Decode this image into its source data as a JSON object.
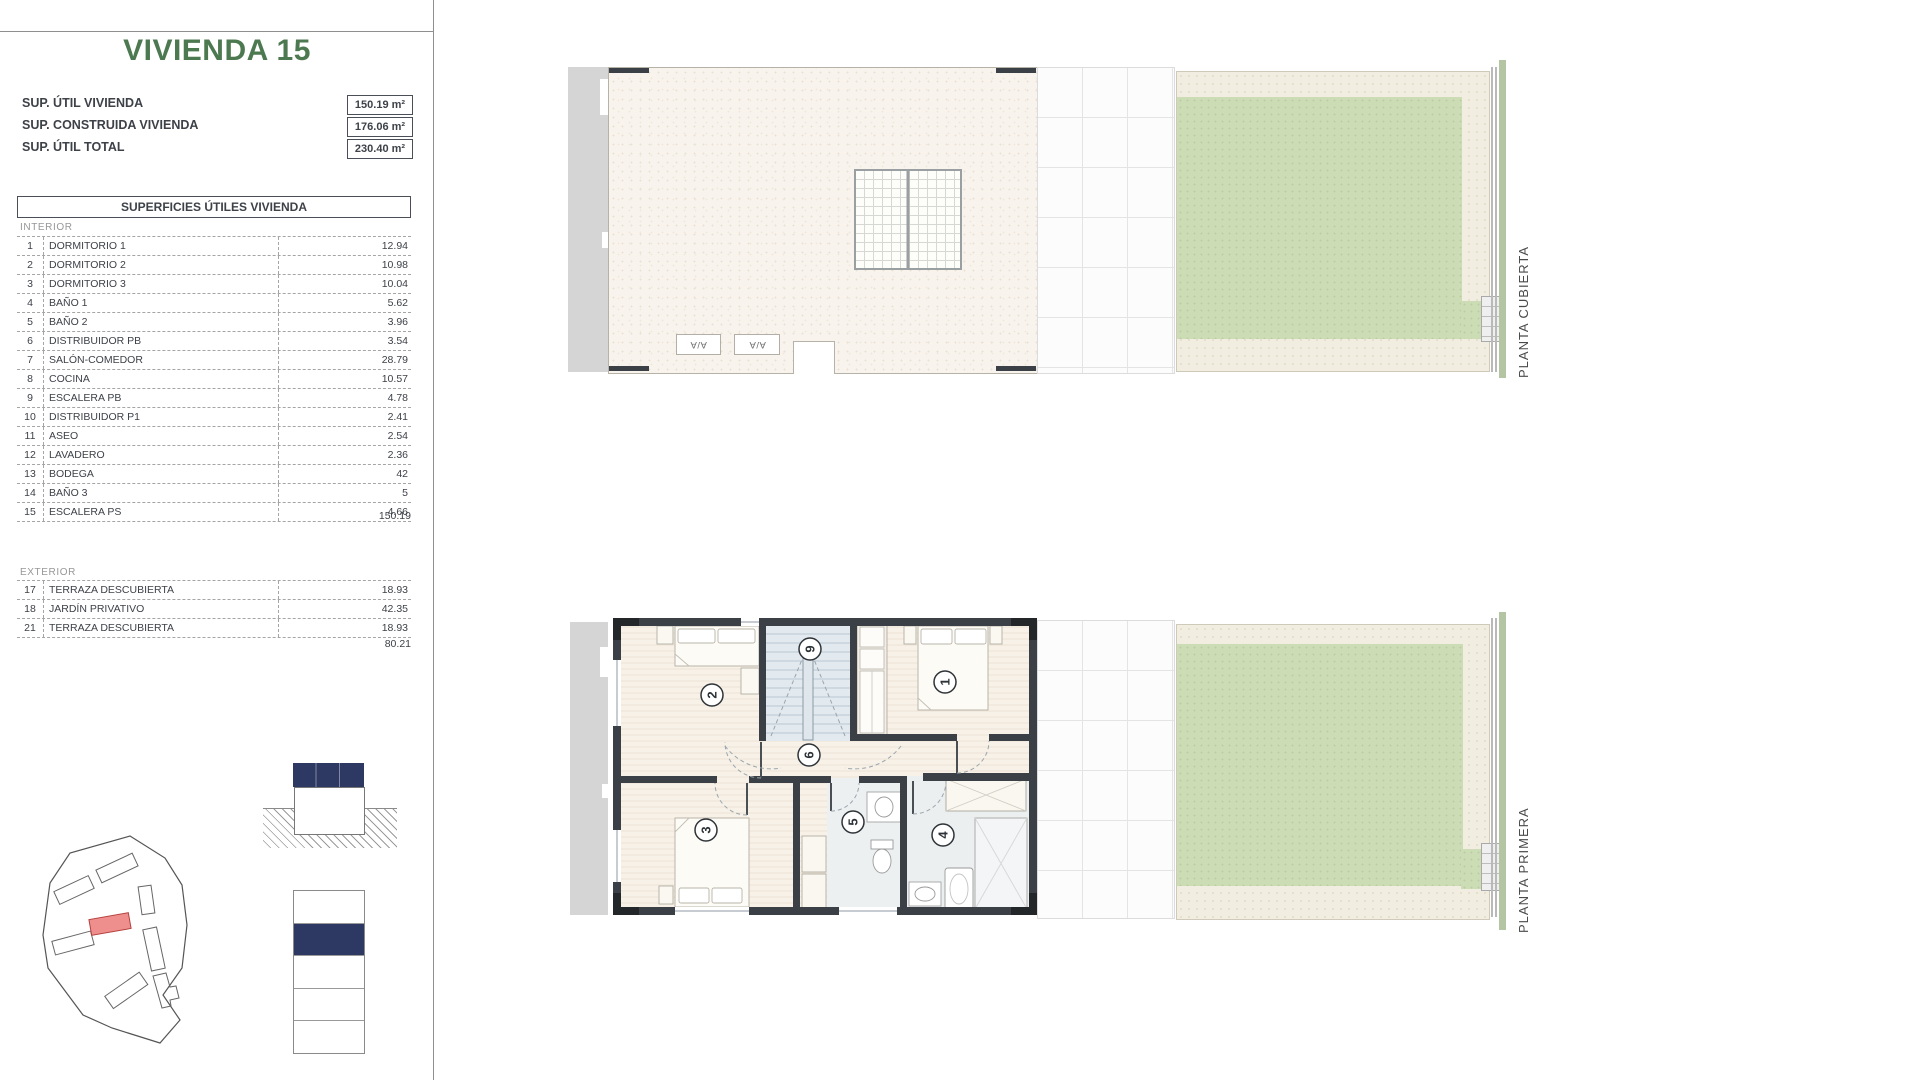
{
  "title": "VIVIENDA 15",
  "summary": {
    "rows": [
      {
        "label": "SUP. ÚTIL VIVIENDA",
        "value": "150.19 m²"
      },
      {
        "label": "SUP. CONSTRUIDA VIVIENDA",
        "value": "176.06 m²"
      },
      {
        "label": "SUP. ÚTIL TOTAL",
        "value": "230.40 m²"
      }
    ]
  },
  "areas_table": {
    "header": "SUPERFICIES ÚTILES VIVIENDA",
    "interior": {
      "label": "INTERIOR",
      "rows": [
        {
          "num": "1",
          "name": "DORMITORIO 1",
          "value": "12.94"
        },
        {
          "num": "2",
          "name": "DORMITORIO 2",
          "value": "10.98"
        },
        {
          "num": "3",
          "name": "DORMITORIO 3",
          "value": "10.04"
        },
        {
          "num": "4",
          "name": "BAÑO 1",
          "value": "5.62"
        },
        {
          "num": "5",
          "name": "BAÑO 2",
          "value": "3.96"
        },
        {
          "num": "6",
          "name": "DISTRIBUIDOR PB",
          "value": "3.54"
        },
        {
          "num": "7",
          "name": "SALÓN-COMEDOR",
          "value": "28.79"
        },
        {
          "num": "8",
          "name": "COCINA",
          "value": "10.57"
        },
        {
          "num": "9",
          "name": "ESCALERA PB",
          "value": "4.78"
        },
        {
          "num": "10",
          "name": "DISTRIBUIDOR P1",
          "value": "2.41"
        },
        {
          "num": "11",
          "name": "ASEO",
          "value": "2.54"
        },
        {
          "num": "12",
          "name": "LAVADERO",
          "value": "2.36"
        },
        {
          "num": "13",
          "name": "BODEGA",
          "value": "42"
        },
        {
          "num": "14",
          "name": "BAÑO 3",
          "value": "5"
        },
        {
          "num": "15",
          "name": "ESCALERA PS",
          "value": "4.66"
        }
      ],
      "total": "150.19"
    },
    "exterior": {
      "label": "EXTERIOR",
      "rows": [
        {
          "num": "17",
          "name": "TERRAZA DESCUBIERTA",
          "value": "18.93"
        },
        {
          "num": "18",
          "name": "JARDÍN PRIVATIVO",
          "value": "42.35"
        },
        {
          "num": "21",
          "name": "TERRAZA DESCUBIERTA",
          "value": "18.93"
        }
      ],
      "total": "80.21"
    }
  },
  "plans": [
    {
      "label": "PLANTA CUBIERTA",
      "ac_units": [
        "A/A",
        "A/A"
      ]
    },
    {
      "label": "PLANTA PRIMERA",
      "room_numbers": [
        "1",
        "2",
        "3",
        "4",
        "5",
        "6",
        "9"
      ]
    }
  ],
  "colors": {
    "accent_green": "#4d7950",
    "navy": "#2e3963",
    "highlight_red": "#ef8f8d",
    "garden_green": "#ccdcb5",
    "roof_cream": "#f8f3ec",
    "wall_dark": "#3a4045"
  }
}
